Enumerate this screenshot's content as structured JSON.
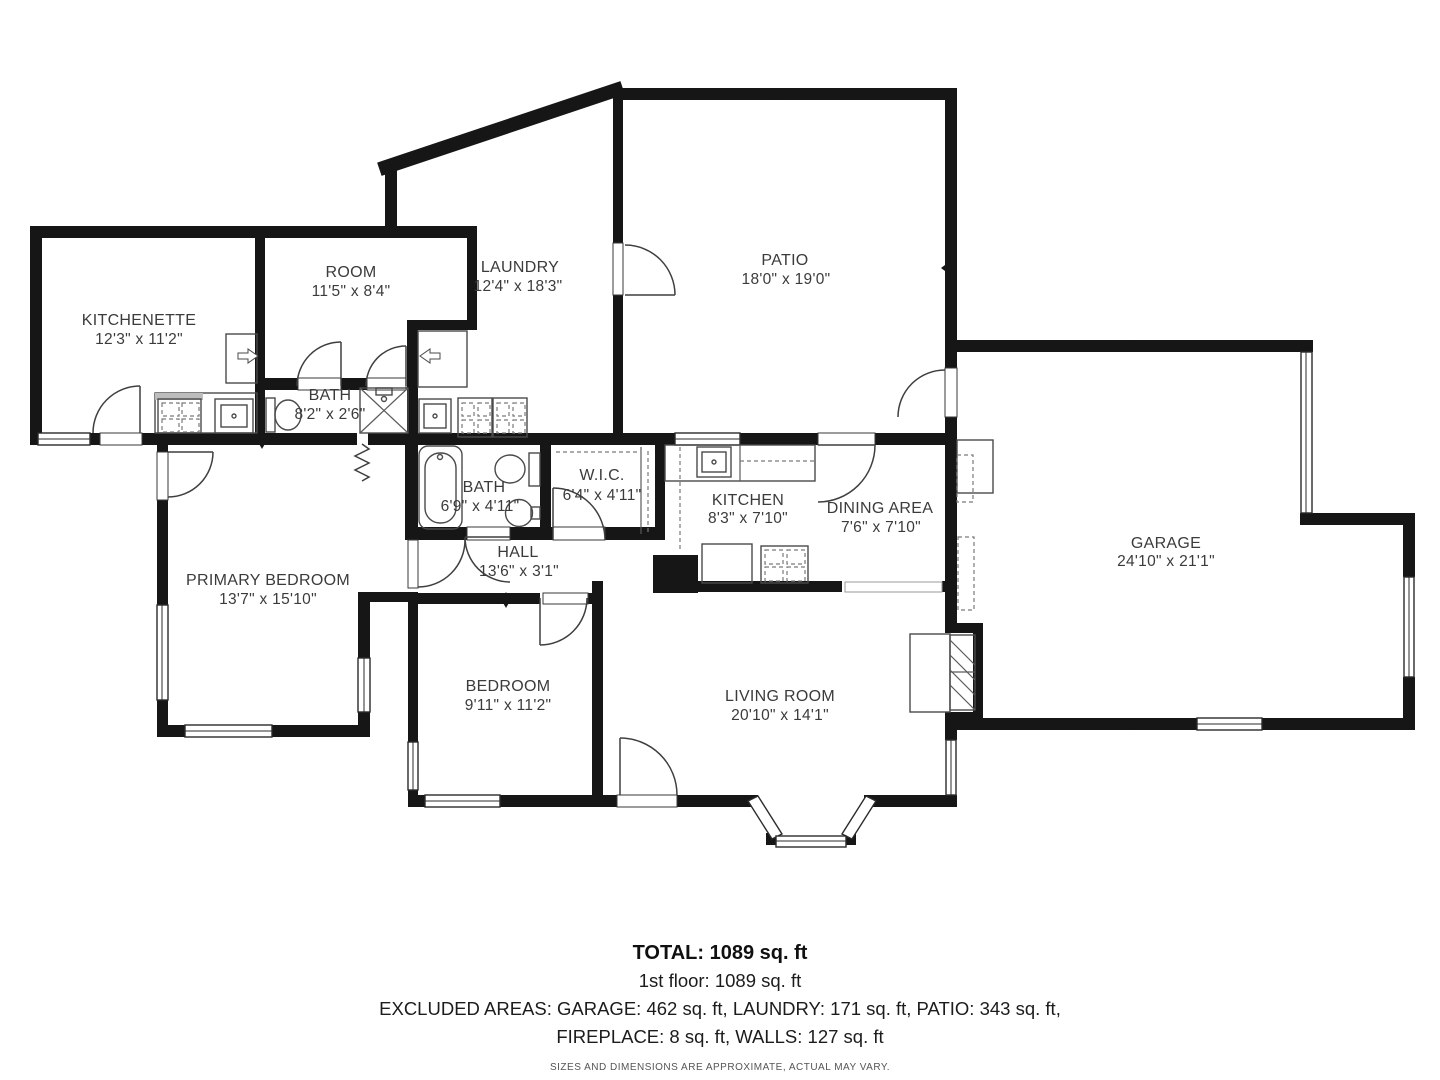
{
  "rooms": [
    {
      "id": "kitchenette",
      "name": "KITCHENETTE",
      "dims": "12'3\" x 11'2\""
    },
    {
      "id": "room",
      "name": "ROOM",
      "dims": "11'5\" x 8'4\""
    },
    {
      "id": "laundry",
      "name": "LAUNDRY",
      "dims": "12'4\" x 18'3\""
    },
    {
      "id": "patio",
      "name": "PATIO",
      "dims": "18'0\" x 19'0\""
    },
    {
      "id": "bath-small",
      "name": "BATH",
      "dims": "8'2\" x 2'6\""
    },
    {
      "id": "bath",
      "name": "BATH",
      "dims": "6'9\" x 4'11\""
    },
    {
      "id": "wic",
      "name": "W.I.C.",
      "dims": "6'4\" x 4'11\""
    },
    {
      "id": "kitchen",
      "name": "KITCHEN",
      "dims": "8'3\" x 7'10\""
    },
    {
      "id": "dining-area",
      "name": "DINING AREA",
      "dims": "7'6\" x 7'10\""
    },
    {
      "id": "garage",
      "name": "GARAGE",
      "dims": "24'10\" x 21'1\""
    },
    {
      "id": "primary-bedroom",
      "name": "PRIMARY BEDROOM",
      "dims": "13'7\" x 15'10\""
    },
    {
      "id": "hall",
      "name": "HALL",
      "dims": "13'6\" x 3'1\""
    },
    {
      "id": "bedroom",
      "name": "BEDROOM",
      "dims": "9'11\" x 11'2\""
    },
    {
      "id": "living-room",
      "name": "LIVING ROOM",
      "dims": "20'10\" x 14'1\""
    }
  ],
  "summary": {
    "total": "TOTAL: 1089 sq. ft",
    "first_floor": "1st floor: 1089 sq. ft",
    "excluded_line1": "EXCLUDED AREAS: GARAGE: 462 sq. ft, LAUNDRY: 171 sq. ft, PATIO: 343 sq. ft,",
    "excluded_line2": "FIREPLACE: 8 sq. ft, WALLS: 127 sq. ft",
    "disclaimer": "SIZES AND DIMENSIONS ARE APPROXIMATE, ACTUAL MAY VARY."
  }
}
